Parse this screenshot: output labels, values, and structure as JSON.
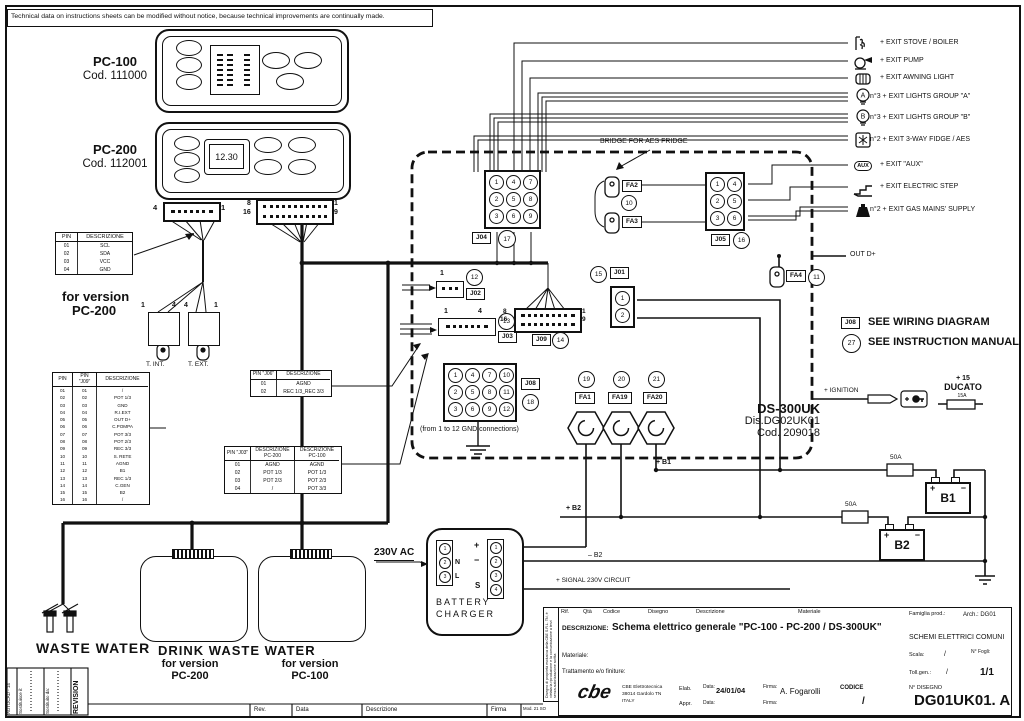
{
  "disclaimer": "Technical data on instructions sheets can be modified without notice, because technical improvements are continually made.",
  "panels": {
    "pc100_name": "PC-100",
    "pc100_code": "Cod. 111000",
    "pc200_name": "PC-200",
    "pc200_code": "Cod. 112001",
    "pc200_display": "12.30"
  },
  "connector_pins": {
    "four_left": "4",
    "four_right": "1",
    "sixteen_tl": "8",
    "sixteen_bl": "16",
    "sixteen_tr": "1",
    "sixteen_br": "9",
    "j09_tl": "8",
    "j09_bl": "16",
    "j09_tr": "1",
    "j09_br": "9",
    "tint_1": "1",
    "tint_4": "4",
    "text_4": "4",
    "text_1": "1",
    "j02_1": "1",
    "j03_1": "1",
    "j03_4": "4"
  },
  "labels": {
    "for_version": "for version",
    "pc200": "PC-200",
    "pc100": "PC-100",
    "t_int": "T. INT.",
    "t_ext": "T. EXT.",
    "bridge": "BRIDGE FOR AES FRIDGE",
    "out_d": "OUT D+",
    "see_wiring": "SEE WIRING DIAGRAM",
    "see_manual": "SEE INSTRUCTION MANUAL",
    "ignition": "+ IGNITION",
    "plus15": "+ 15",
    "ducato": "DUCATO",
    "fuse15": "15A",
    "gnd_note": "(from 1 to 12 GND connections)",
    "waste": "WASTE WATER",
    "drink": "DRINK WASTE WATER",
    "ac": "230V AC",
    "battery": "BATTERY",
    "charger": "CHARGER",
    "n": "N",
    "l": "L",
    "plus": "+",
    "minus": "−",
    "s": "S",
    "plus_b1": "+ B1",
    "plus_b2": "+ B2",
    "minus_b2": "– B2",
    "signal": "+ SIGNAL 230V CIRCUIT",
    "fuse50a": "50A",
    "fuse50b": "50A",
    "b1": "B1",
    "b2": "B2"
  },
  "device": {
    "name": "DS-300UK",
    "drawing": "Dis.DG02UK01",
    "code": "Cod. 209018"
  },
  "refs": {
    "j01": "J01",
    "j02": "J02",
    "j03": "J03",
    "j04": "J04",
    "j05": "J05",
    "j08": "J08",
    "j09": "J09",
    "c10": "10",
    "c11": "11",
    "c12": "12",
    "c13": "13",
    "c14": "14",
    "c15": "15",
    "c16": "16",
    "c17": "17",
    "c18": "18",
    "c19": "19",
    "c20": "20",
    "c21": "21",
    "c27": "27",
    "fa1": "FA1",
    "fa2": "FA2",
    "fa3": "FA3",
    "fa4": "FA4",
    "fa19": "FA19",
    "fa20": "FA20",
    "see_j08": "J08"
  },
  "exits": [
    {
      "label": "+ EXIT STOVE / BOILER"
    },
    {
      "label": "+ EXIT PUMP"
    },
    {
      "label": "+ EXIT AWNING LIGHT"
    },
    {
      "label": "n°3 + EXIT LIGHTS GROUP \"A\""
    },
    {
      "label": "n°3 + EXIT LIGHTS GROUP \"B\""
    },
    {
      "label": "n°2 + EXIT 3-WAY FIDGE / AES"
    },
    {
      "label": "+ EXIT \"AUX\""
    },
    {
      "label": "+ EXIT ELECTRIC STEP"
    },
    {
      "label": "n°2 + EXIT GAS MAINS' SUPPLY"
    }
  ],
  "icons": {
    "aux": "AUX",
    "bulb_a": "A",
    "bulb_b": "B"
  },
  "tables": {
    "i2c": {
      "headers": [
        "PIN",
        "DESCRIZIONE"
      ],
      "rows": [
        [
          "01",
          "SCL"
        ],
        [
          "02",
          "SDA"
        ],
        [
          "03",
          "VCC"
        ],
        [
          "04",
          "GND"
        ]
      ]
    },
    "j09": {
      "headers": [
        "PIN",
        "PIN \"J09\"",
        "DESCRIZIONE"
      ],
      "rows": [
        [
          "01",
          "01",
          "/"
        ],
        [
          "02",
          "02",
          "POT 1/3"
        ],
        [
          "03",
          "03",
          "GND"
        ],
        [
          "04",
          "04",
          "R.I.EXT"
        ],
        [
          "05",
          "05",
          "OUT D+"
        ],
        [
          "06",
          "06",
          "C.POMPA"
        ],
        [
          "07",
          "07",
          "POT 3/3"
        ],
        [
          "08",
          "08",
          "POT 2/3"
        ],
        [
          "09",
          "09",
          "REC 3/3"
        ],
        [
          "10",
          "10",
          "S. RETE"
        ],
        [
          "11",
          "11",
          "AGND"
        ],
        [
          "12",
          "12",
          "B1"
        ],
        [
          "13",
          "13",
          "REC 1/3"
        ],
        [
          "14",
          "14",
          "C.GEN"
        ],
        [
          "15",
          "15",
          "B2"
        ],
        [
          "16",
          "16",
          "/"
        ]
      ]
    },
    "j06": {
      "headers": [
        "PIN \"J06\"",
        "DESCRIZIONE"
      ],
      "rows": [
        [
          "01",
          "AGND"
        ],
        [
          "02",
          "REC 1/3_REC 3/3"
        ]
      ]
    },
    "j03": {
      "headers": [
        "PIN \"J03\"",
        "DESCRIZIONE PC-200",
        "DESCRIZIONE PC-100"
      ],
      "rows": [
        [
          "01",
          "AGND",
          "AGND"
        ],
        [
          "02",
          "POT 1/3",
          "POT 1/3"
        ],
        [
          "03",
          "POT 2/3",
          "POT 2/3"
        ],
        [
          "04",
          "/",
          "POT 3/3"
        ]
      ]
    }
  },
  "grids": {
    "j04": [
      [
        "1",
        "4",
        "7"
      ],
      [
        "2",
        "5",
        "8"
      ],
      [
        "3",
        "6",
        "9"
      ]
    ],
    "j05": [
      [
        "1",
        "4"
      ],
      [
        "2",
        "5"
      ],
      [
        "3",
        "6"
      ]
    ],
    "j08": [
      [
        "1",
        "4",
        "7",
        "10"
      ],
      [
        "2",
        "5",
        "8",
        "11"
      ],
      [
        "3",
        "6",
        "9",
        "12"
      ]
    ],
    "j01": [
      [
        "1"
      ],
      [
        "2"
      ]
    ],
    "charger_left": [
      [
        "1"
      ],
      [
        "2"
      ],
      [
        "3"
      ]
    ],
    "charger_right": [
      [
        "1"
      ],
      [
        "2"
      ],
      [
        "3"
      ],
      [
        "4"
      ]
    ]
  },
  "titleblock": {
    "cols": [
      "Rif.",
      "Qtà",
      "Codice",
      "Disegno",
      "Descrizione",
      "Materiale"
    ],
    "descr_label": "DESCRIZIONE:",
    "descr_value": "Schema elettrico generale \"PC-100 - PC-200 / DS-300UK\"",
    "materiale": "Materiale:",
    "trattamento": "Trattamento e/o finiture:",
    "famiglia": "Famiglia prod.:",
    "arch": "Arch.: DG01",
    "schemi": "SCHEMI ELETTRICI COMUNI",
    "scala": "Scala:",
    "scala_v": "/",
    "fogli": "N° Fogli:",
    "toll": "Toll.gen.:",
    "toll_v": "/",
    "fogli_v": "1/1",
    "logo": "cbe",
    "company": "CBE Elettrotecnica",
    "addr1": "38014 Gardolo TN",
    "addr2": "ITALY",
    "elab": "Elab.",
    "appr": "Appr.",
    "data_label": "Data:",
    "data_value": "24/01/04",
    "firma_label": "Firma:",
    "firma_value": "A. Fogarolli",
    "data_label2": "Data:",
    "firma_label2": "Firma:",
    "codice_label": "CODICE",
    "codice_value": "/",
    "ndisegno_label": "N° DISEGNO",
    "ndisegno_value": "DG01UK01. A",
    "side_note": "Disegno di proprietà esclusiva della CBE S.R.L. TN, è vietata la riproduzione e la comunicazione a terzi senza autorizzazione scritta",
    "mod": "Mod. 21 SO"
  },
  "revision": {
    "autocad": "AUTOCAD - 14",
    "sost1": "Sostituisce il:",
    "sost2": "Sostituito da:",
    "title": "REVISION",
    "rev": "Rev.",
    "data": "Data",
    "descr": "Descrizione",
    "firma": "Firma"
  }
}
